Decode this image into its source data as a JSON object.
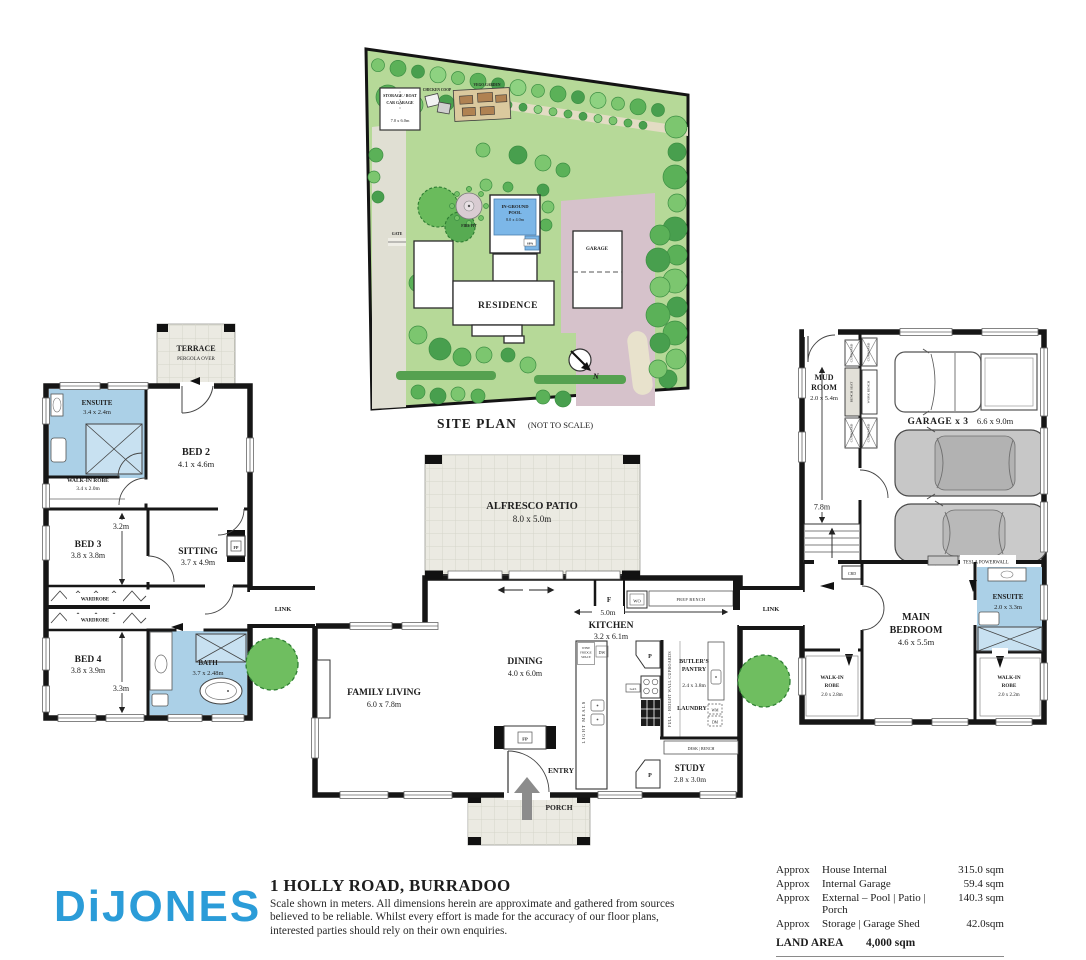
{
  "site_plan": {
    "caption": "SITE PLAN",
    "caption_note": "(NOT TO SCALE)",
    "storage": {
      "line1": "STORAGE / BOAT",
      "line2": "CAR GARAGE",
      "dim": "7.0 x 6.0m"
    },
    "chicken_coop": "CHICKEN COOP",
    "veggie_garden": "VEGO GARDEN",
    "fire_pit": "FIRE PIT",
    "pool": {
      "line1": "IN-GROUND",
      "line2": "POOL",
      "dim": "8.0 x 4.0m",
      "spa": "SPA"
    },
    "gate": "GATE",
    "residence": "RESIDENCE",
    "garage": "GARAGE",
    "north": "N"
  },
  "floor_plan": {
    "terrace": {
      "name": "TERRACE",
      "sub": "PERGOLA OVER"
    },
    "ensuite2": {
      "name": "ENSUITE",
      "dim": "3.4 x 2.4m"
    },
    "bed2": {
      "name": "BED 2",
      "dim": "4.1 x 4.6m"
    },
    "wir2": {
      "name": "WALK-IN ROBE",
      "dim": "3.4 x 2.0m"
    },
    "bed3": {
      "name": "BED 3",
      "dim": "3.8 x 3.8m"
    },
    "sitting": {
      "name": "SITTING",
      "dim": "3.7 x 4.9m"
    },
    "wardrobe": "WARDROBE",
    "bed4": {
      "name": "BED 4",
      "dim": "3.8 x 3.9m"
    },
    "bath": {
      "name": "BATH",
      "dim": "3.7 x 2.48m"
    },
    "link": "LINK",
    "alfresco": {
      "name": "ALFRESCO PATIO",
      "dim": "8.0 x 5.0m"
    },
    "kitchen": {
      "name": "KITCHEN",
      "dim": "3.2 x 6.1m"
    },
    "dining": {
      "name": "DINING",
      "dim": "4.0 x 6.0m"
    },
    "family_living": {
      "name": "FAMILY LIVING",
      "dim": "6.0 x 7.8m"
    },
    "butlers_pantry": {
      "line1": "BUTLER'S",
      "line2": "PANTRY",
      "dim": "2.4 x 3.8m"
    },
    "laundry": "LAUNDRY",
    "study": {
      "name": "STUDY",
      "dim": "2.8 x 3.0m"
    },
    "entry": "ENTRY",
    "porch": "PORCH",
    "mud_room": {
      "line1": "MUD",
      "line2": "ROOM",
      "dim": "2.0 x 5.4m"
    },
    "garage": {
      "name": "GARAGE  x 3",
      "dim": "6.6 x 9.0m"
    },
    "main_bedroom": {
      "line1": "MAIN",
      "line2": "BEDROOM",
      "dim": "4.6 x 5.5m"
    },
    "ensuite_main": {
      "name": "ENSUITE",
      "dim": "2.0 x 3.3m"
    },
    "wir_main_left": {
      "line1": "WALK-IN",
      "line2": "ROBE",
      "dim": "2.0 x 2.8m"
    },
    "wir_main_right": {
      "line1": "WALK-IN",
      "line2": "ROBE",
      "dim": "2.0 x 2.2m"
    },
    "fixtures": {
      "fp": "FP",
      "f": "F",
      "wo": "WO",
      "prep_bench": "PREP BENCH",
      "wine_fridge": {
        "line1": "WINE",
        "line2": "FRIDGE",
        "line3": "SPACE"
      },
      "dw": "DW",
      "light_meals": "LIGHT MEALS",
      "p": "P",
      "gas": "GAS",
      "full_height": "FULL - HEIGHT  WALL CUPBOARDS",
      "wm": "WM",
      "dm": "DM",
      "desk_bench": "DESK | BENCH",
      "cupboard": "CUPBOARD",
      "bench_seat": "BENCH SEAT",
      "work_bench": "WORK BENCH",
      "tesla": "TESLA POWERWALL",
      "cbd": "CBD"
    },
    "dims": {
      "bed3_w": "3.2m",
      "bed4_w": "3.3m",
      "kitchen_w": "5.0m",
      "garage_d": "7.8m"
    }
  },
  "footer": {
    "brand": "DiJONES",
    "address": "1 HOLLY ROAD, BURRADOO",
    "disclaimer_line1": "Scale shown in meters. All dimensions herein are approximate and gathered from sources",
    "disclaimer_line2": "believed to be reliable. Whilst every effort is made for the accuracy of our floor plans,",
    "disclaimer_line3": "interested parties should rely on their own enquiries.",
    "areas": {
      "approx": "Approx",
      "row1": {
        "label": "House Internal",
        "value": "315.0 sqm"
      },
      "row2": {
        "label": "Internal Garage",
        "value": "59.4 sqm"
      },
      "row3": {
        "label": "External – Pool | Patio | Porch",
        "value": "140.3 sqm"
      },
      "row4": {
        "label": "Storage | Garage Shed",
        "value": "42.0sqm"
      },
      "land": {
        "label": "LAND AREA",
        "value": "4,000 sqm"
      }
    }
  }
}
